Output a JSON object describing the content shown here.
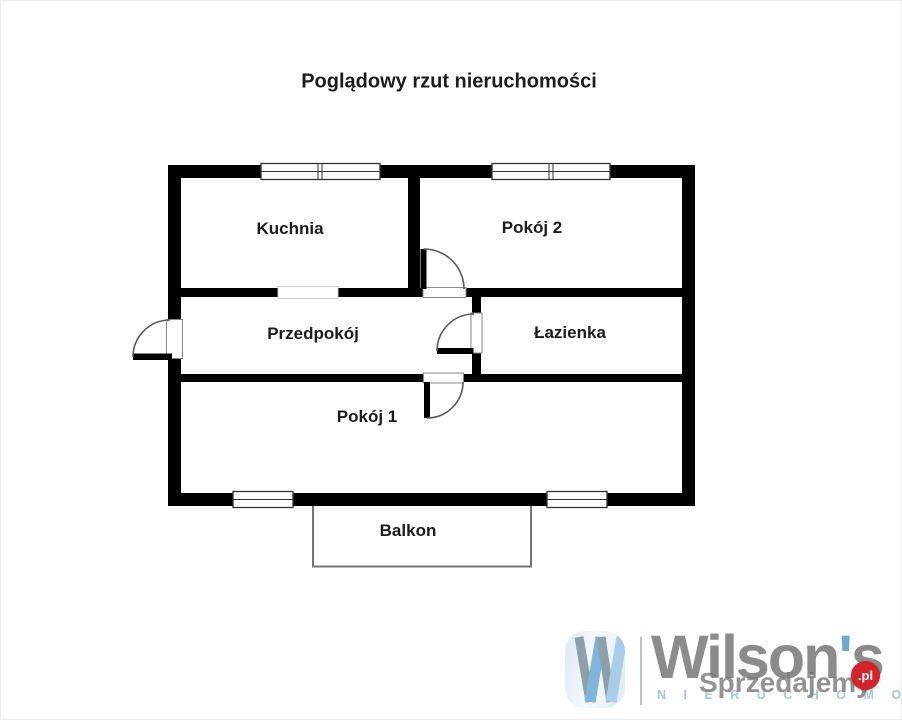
{
  "title": "Poglądowy rzut nieruchomości",
  "rooms": [
    {
      "label": "Kuchnia"
    },
    {
      "label": "Pokój 2"
    },
    {
      "label": "Przedpokój"
    },
    {
      "label": "Łazienka"
    },
    {
      "label": "Pokój 1"
    },
    {
      "label": "Balkon"
    }
  ],
  "branding": {
    "brand_name": "Wilson",
    "brand_apostrophe": "'",
    "brand_suffix": "s",
    "brand_subtitle": "N I E R U C H O M O Ś C I",
    "watermark_text": "Sprzedajemy",
    "watermark_tld": ".pl",
    "colors": {
      "wall": "#000000",
      "door_arc": "#5a5a5a",
      "balcony_outline": "#757575",
      "brand_gray": "#8b8b8b",
      "brand_blue": "#7fb3da",
      "subtitle_blue": "#a3c6de",
      "watermark_red": "#d2232a"
    }
  }
}
